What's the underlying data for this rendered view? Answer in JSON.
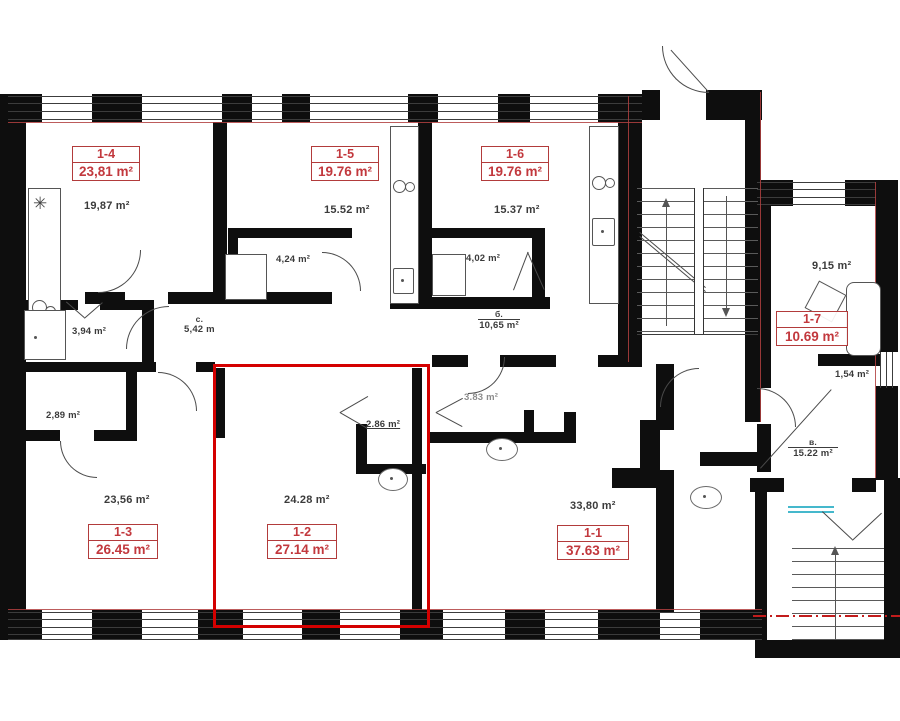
{
  "plan": {
    "units": {
      "u14": {
        "id": "1-4",
        "area": "23,81 m²",
        "room_area": "19,87 m²"
      },
      "u15": {
        "id": "1-5",
        "area": "19.76 m²",
        "room_area": "15.52 m²"
      },
      "u16": {
        "id": "1-6",
        "area": "19.76 m²",
        "room_area": "15.37 m²"
      },
      "u17": {
        "id": "1-7",
        "area": "10.69 m²",
        "room_area": "9,15 m²"
      },
      "u13": {
        "id": "1-3",
        "area": "26.45 m²",
        "room_area": "23,56 m²"
      },
      "u12": {
        "id": "1-2",
        "area": "27.14 m²",
        "room_area": "24.28 m²"
      },
      "u11": {
        "id": "1-1",
        "area": "37.63 m²",
        "room_area": "33,80 m²"
      }
    },
    "rooms": {
      "bath_15": "4,24 m²",
      "bath_16": "4,02 m²",
      "shower_room": "3,94 m²",
      "hall_abbr": "с.",
      "hall_size": "5,42 m",
      "corridor_abbr": "б.",
      "corridor_area": "10,65 m²",
      "closet": "2,89 m²",
      "wc_12": "2.86 m²",
      "wc_11": "3.83 m²",
      "lobby": "1,54 m²",
      "balcony_abbr": "в.",
      "balcony_area": "15.22 m²"
    },
    "icons": {
      "fan": "✳"
    },
    "colors": {
      "highlight": "#d40000",
      "label_red": "#c2383d",
      "wall": "#0e0e0e",
      "glazing": "#45b8cc"
    }
  }
}
